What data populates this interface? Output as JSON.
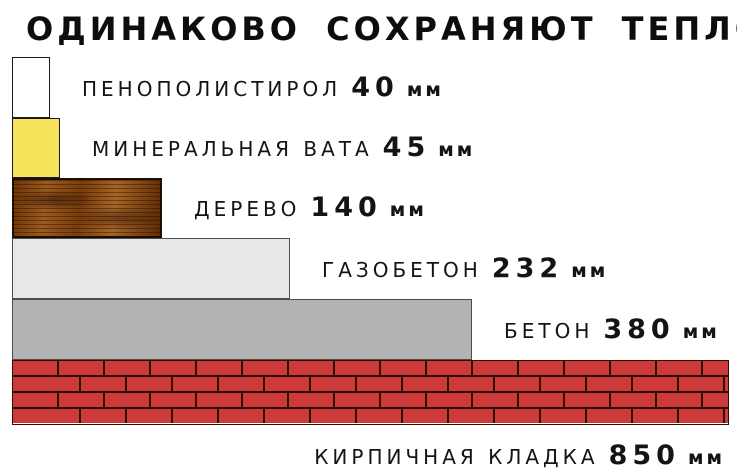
{
  "title": "ОДИНАКОВО СОХРАНЯЮТ ТЕПЛО",
  "chart_data": {
    "type": "bar",
    "orientation": "horizontal",
    "title": "ОДИНАКОВО СОХРАНЯЮТ ТЕПЛО",
    "unit": "мм",
    "categories": [
      "пенополистирол",
      "минеральная вата",
      "дерево",
      "газобетон",
      "бетон",
      "кирпичная кладка"
    ],
    "values": [
      40,
      45,
      140,
      232,
      380,
      850
    ],
    "legend_position": "none",
    "grid": false,
    "rows": [
      {
        "material": "ПЕНОПОЛИСТИРОЛ",
        "value": "40",
        "unit": "мм",
        "fill": "#ffffff",
        "border": "#1a1a1a",
        "texture": "plain",
        "label_position": "right"
      },
      {
        "material": "МИНЕРАЛЬНАЯ ВАТА",
        "value": "45",
        "unit": "мм",
        "fill": "#f8e35c",
        "border": "#1a1a1a",
        "texture": "plain",
        "label_position": "right"
      },
      {
        "material": "ДЕРЕВО",
        "value": "140",
        "unit": "мм",
        "fill": "#8a4a16",
        "border": "#1d0e02",
        "texture": "wood",
        "label_position": "right"
      },
      {
        "material": "ГАЗОБЕТОН",
        "value": "232",
        "unit": "мм",
        "fill": "#e8e8e8",
        "border": "#4d4d4d",
        "texture": "plain",
        "label_position": "right"
      },
      {
        "material": "БЕТОН",
        "value": "380",
        "unit": "мм",
        "fill": "#b3b3b3",
        "border": "#4d4d4d",
        "texture": "plain",
        "label_position": "right"
      },
      {
        "material": "КИРПИЧНАЯ КЛАДКА",
        "value": "850",
        "unit": "мм",
        "fill": "#cd3a3a",
        "border": "#2e0c0c",
        "mortar": "#2e0c0c",
        "texture": "brick",
        "label_position": "below"
      }
    ]
  }
}
